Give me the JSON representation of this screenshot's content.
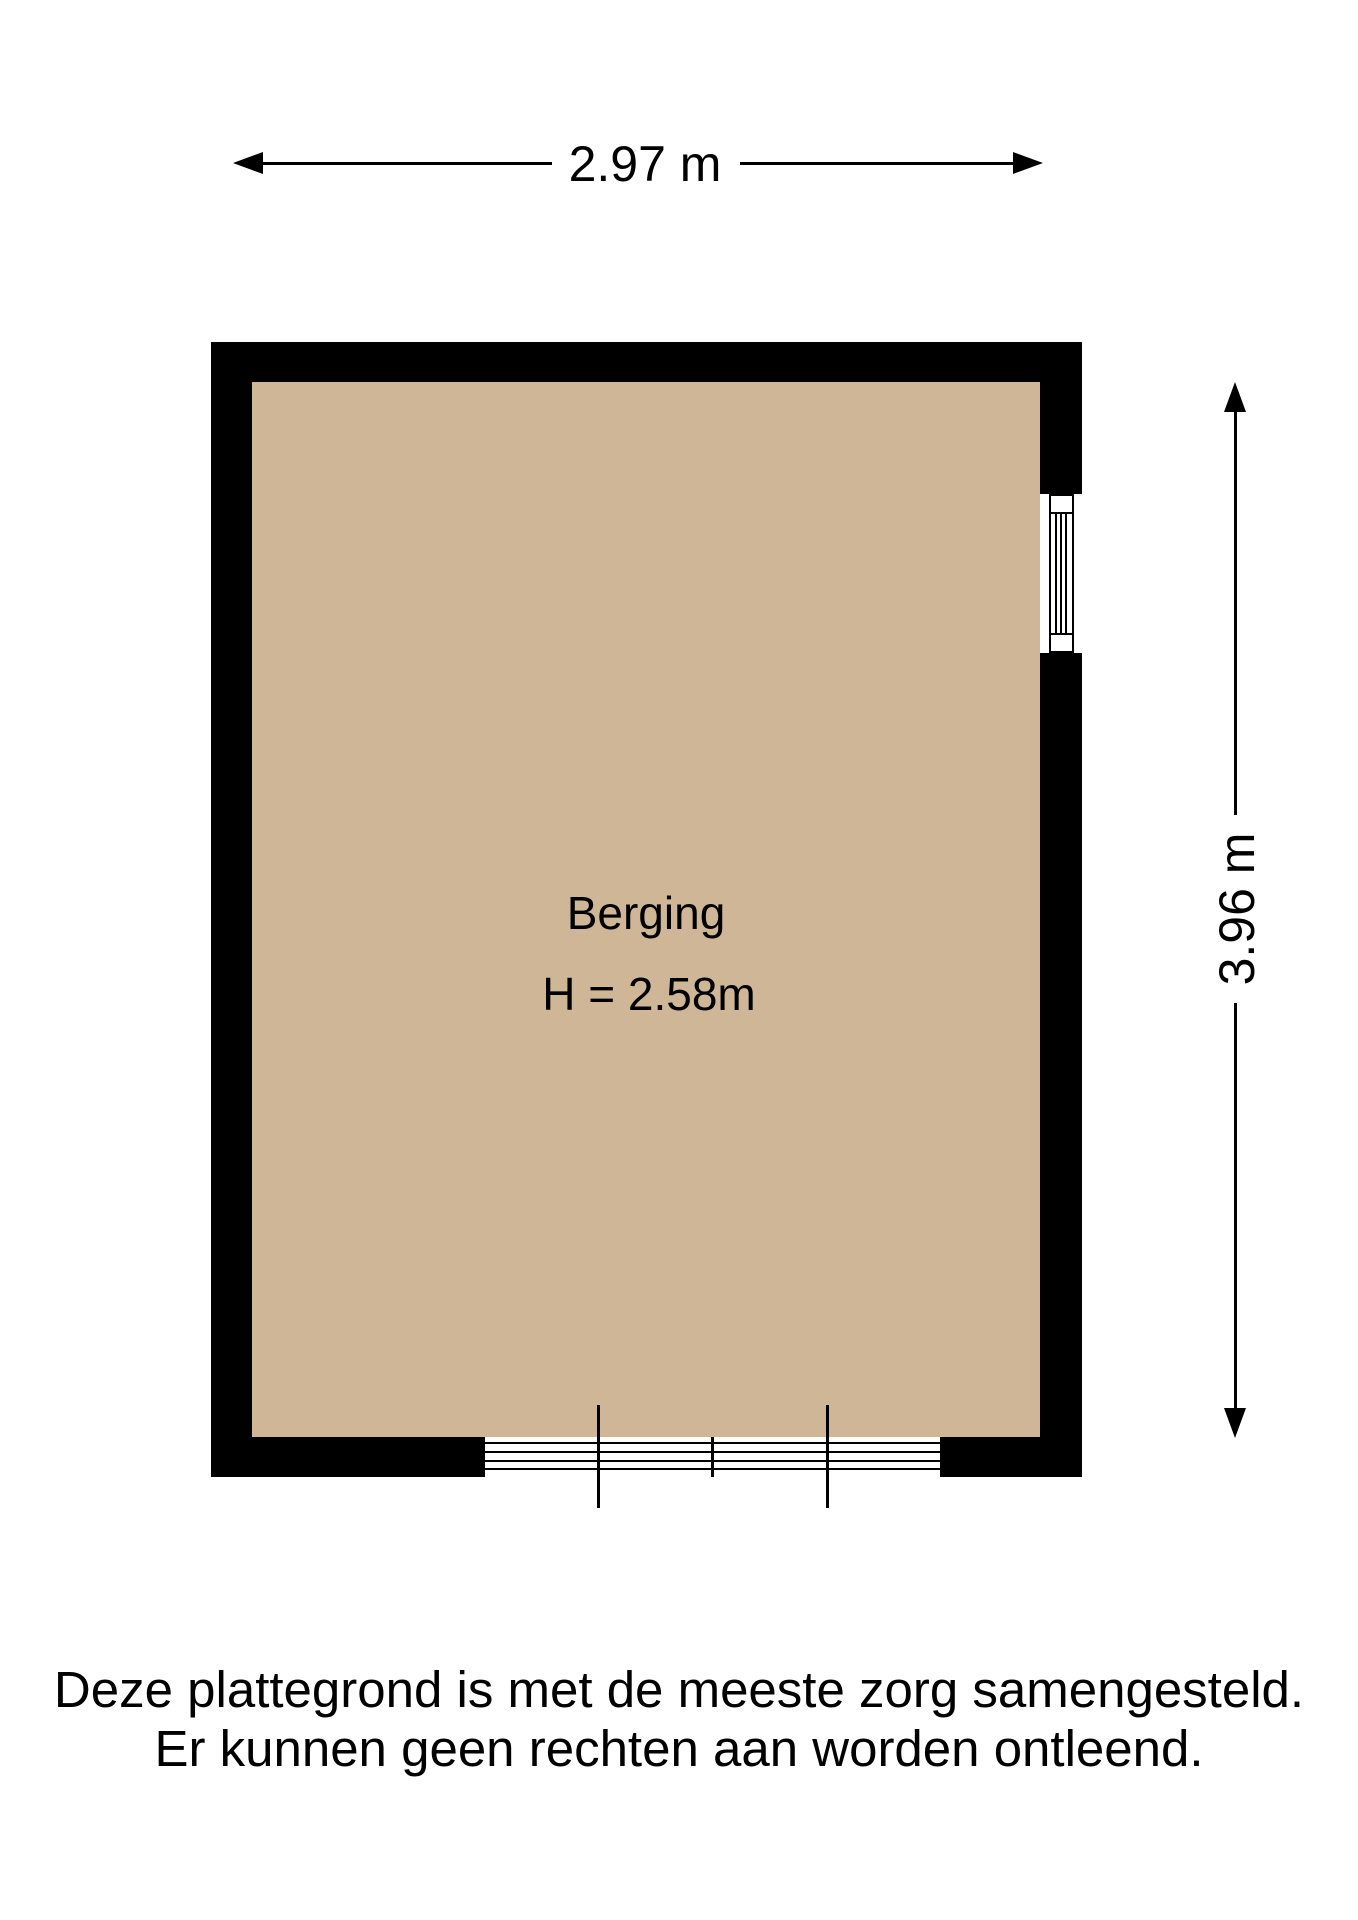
{
  "dimensions": {
    "width_label": "2.97 m",
    "depth_label": "3.96 m"
  },
  "room": {
    "name": "Berging",
    "ceiling_height_label": "H = 2.58m"
  },
  "disclaimer": {
    "line1": "Deze plattegrond is met de meeste zorg samengesteld.",
    "line2": "Er kunnen geen rechten aan worden ontleend."
  },
  "colors": {
    "background": "#FFFFFF",
    "wall": "#000000",
    "floor": "#CEB697",
    "line": "#000000"
  }
}
